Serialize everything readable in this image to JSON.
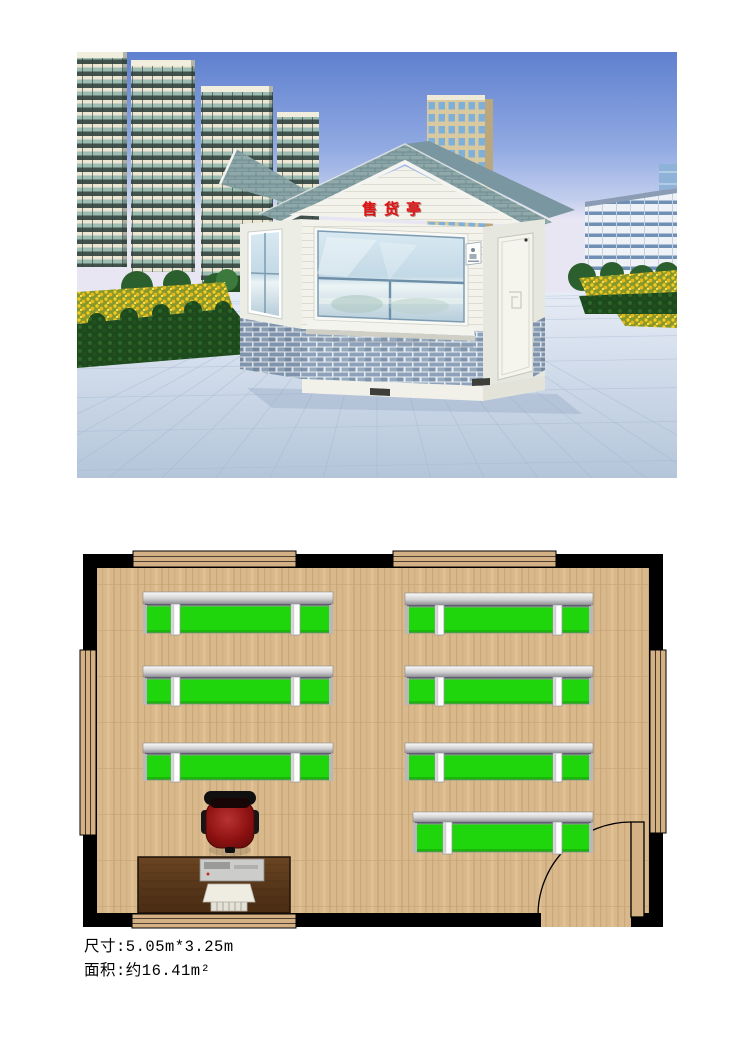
{
  "page": {
    "background": "#ffffff"
  },
  "photo": {
    "description": "3D render of a small retail kiosk in a landscaped plaza with residential towers",
    "sign_text": "售货亭",
    "sign_color": "#e01212",
    "colors": {
      "sky_top": "#5f80cf",
      "sky_horizon": "#e9e6f4",
      "roof_shingle": "#8fa9ab",
      "kiosk_wall": "#f3f3ec",
      "brick_band": "#8da2ba",
      "window_glass": "#c9dde9",
      "flowers": "#f2cc1e",
      "hedge": "#1d4a1c",
      "paving": "#c7d4e6"
    }
  },
  "floorplan": {
    "size_px": {
      "w": 580,
      "h": 373
    },
    "colors": {
      "wall": "#000000",
      "floor": "#d9b98c",
      "window": "#d4b184",
      "shelf_green": "#1fd60d",
      "post": "#ffffff",
      "chair": "#8e1111",
      "desk": "#58371a"
    },
    "walls": [
      {
        "x": 0,
        "y": 0,
        "w": 580,
        "h": 14
      },
      {
        "x": 0,
        "y": 359,
        "w": 580,
        "h": 14
      },
      {
        "x": 0,
        "y": 0,
        "w": 14,
        "h": 373
      },
      {
        "x": 566,
        "y": 0,
        "w": 14,
        "h": 373
      }
    ],
    "windows": [
      {
        "x": 50,
        "y": -3,
        "w": 163,
        "h": 16
      },
      {
        "x": 310,
        "y": -3,
        "w": 163,
        "h": 16
      },
      {
        "x": 49,
        "y": 360,
        "w": 164,
        "h": 14
      },
      {
        "x": -3,
        "y": 96,
        "w": 16,
        "h": 185
      },
      {
        "x": 567,
        "y": 96,
        "w": 16,
        "h": 183
      }
    ],
    "door": {
      "opening": {
        "x": 458,
        "y": 358,
        "w": 90,
        "h": 15
      },
      "leaf": {
        "x": 548,
        "y": 268,
        "w": 13,
        "h": 95
      },
      "arc": "M548,268 A93,93 0 0 0 455,361"
    },
    "shelves": [
      {
        "x": 60,
        "w": 190,
        "railY": 38,
        "railH": 12,
        "gy": 52,
        "gh": 27,
        "posts": [
          88,
          208
        ]
      },
      {
        "x": 322,
        "w": 188,
        "railY": 39,
        "railH": 12,
        "gy": 53,
        "gh": 26,
        "posts": [
          352,
          470
        ]
      },
      {
        "x": 60,
        "w": 190,
        "railY": 112,
        "railH": 11,
        "gy": 125,
        "gh": 25,
        "posts": [
          88,
          208
        ]
      },
      {
        "x": 322,
        "w": 188,
        "railY": 112,
        "railH": 11,
        "gy": 125,
        "gh": 25,
        "posts": [
          352,
          470
        ]
      },
      {
        "x": 60,
        "w": 190,
        "railY": 189,
        "railH": 10,
        "gy": 201,
        "gh": 25,
        "posts": [
          88,
          208
        ]
      },
      {
        "x": 322,
        "w": 188,
        "railY": 189,
        "railH": 10,
        "gy": 201,
        "gh": 25,
        "posts": [
          352,
          470
        ]
      },
      {
        "x": 330,
        "w": 180,
        "railY": 258,
        "railH": 10,
        "gy": 270,
        "gh": 28,
        "posts": [
          360,
          470
        ]
      }
    ],
    "chair": {
      "cx": 147,
      "cy": 268
    },
    "desk": {
      "x": 55,
      "y": 303,
      "w": 152,
      "h": 56
    }
  },
  "specs": {
    "size_label": "尺寸:5.05m*3.25m",
    "area_label": "面积:约16.41m²"
  }
}
